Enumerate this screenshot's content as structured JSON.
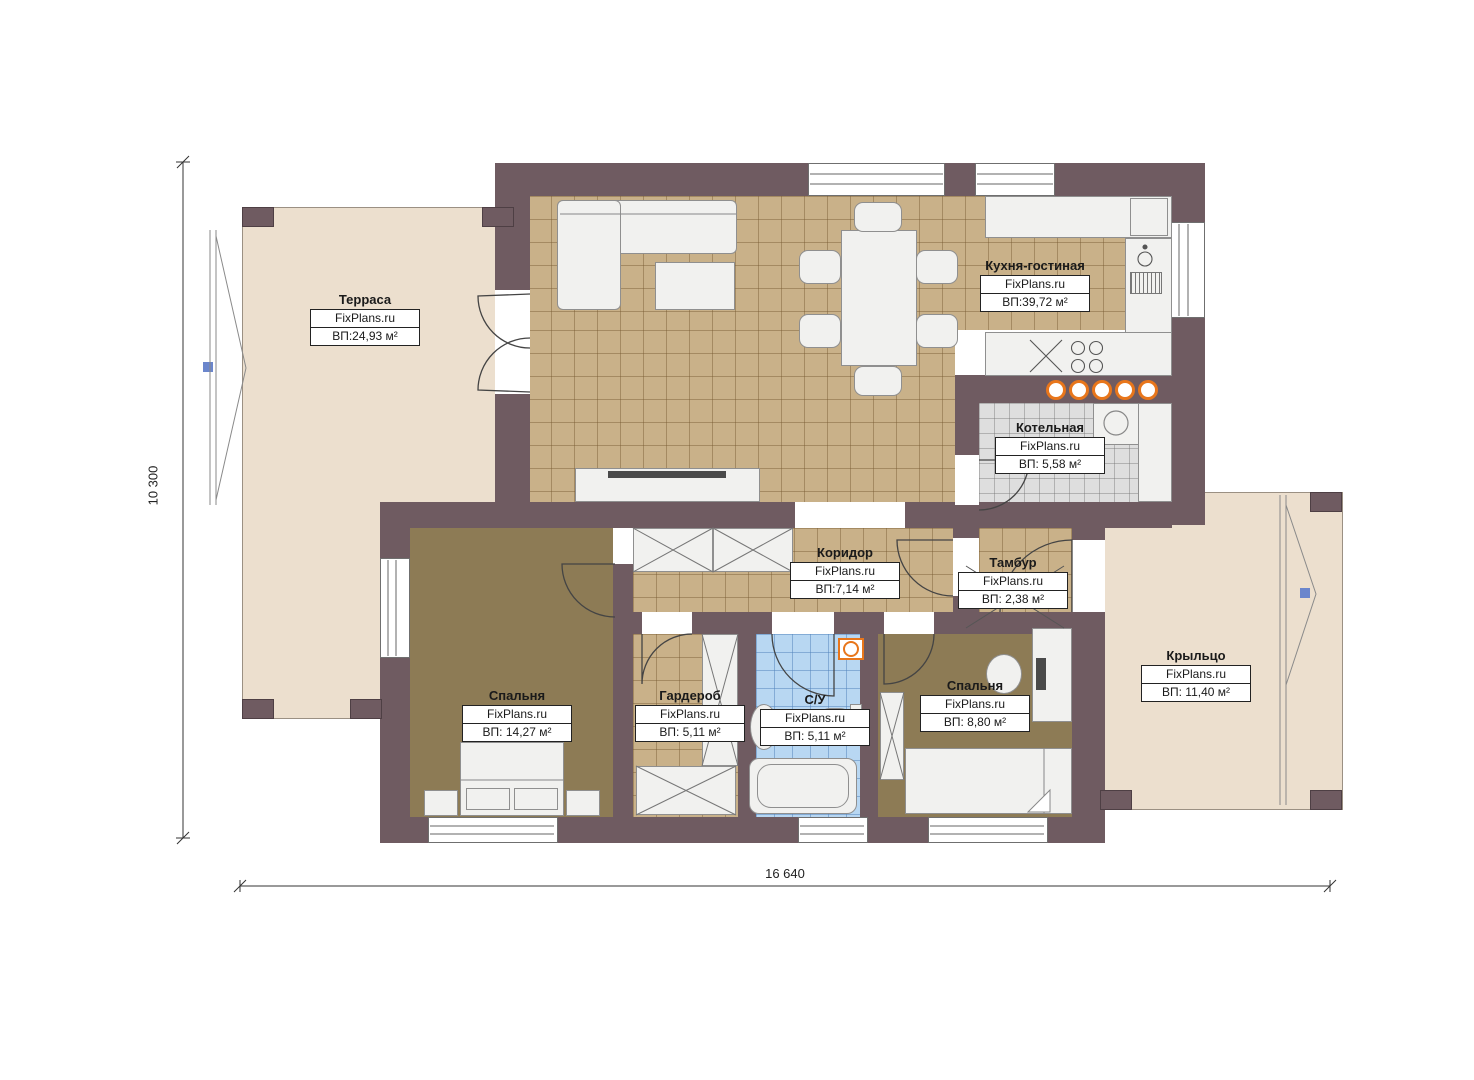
{
  "plan": {
    "type": "floor-plan",
    "brand_watermark": "FixPlans.ru",
    "dimensions": {
      "width_label": "16 640",
      "height_label": "10 300"
    },
    "colors": {
      "wall": "#6f5b61",
      "tile_floor": "#c9b189",
      "carpet": "#8d7b55",
      "bathroom_tile": "#b8d7f2",
      "boiler_tile": "#dedede",
      "terrace_deck": "#ecdfce",
      "accent_orange": "#e8761b",
      "marker_blue": "#6b86cc"
    }
  },
  "rooms": [
    {
      "name": "Терраса",
      "brand": "FixPlans.ru",
      "area": "ВП:24,93 м²"
    },
    {
      "name": "Кухня-гостиная",
      "brand": "FixPlans.ru",
      "area": "ВП:39,72 м²"
    },
    {
      "name": "Котельная",
      "brand": "FixPlans.ru",
      "area": "ВП: 5,58 м²"
    },
    {
      "name": "Коридор",
      "brand": "FixPlans.ru",
      "area": "ВП:7,14 м²"
    },
    {
      "name": "Тамбур",
      "brand": "FixPlans.ru",
      "area": "ВП: 2,38 м²"
    },
    {
      "name": "Спальня",
      "brand": "FixPlans.ru",
      "area": "ВП: 14,27 м²"
    },
    {
      "name": "Гардероб",
      "brand": "FixPlans.ru",
      "area": "ВП: 5,11 м²"
    },
    {
      "name": "С/У",
      "brand": "FixPlans.ru",
      "area": "ВП: 5,11 м²"
    },
    {
      "name": "Спальня",
      "brand": "FixPlans.ru",
      "area": "ВП: 8,80 м²"
    },
    {
      "name": "Крыльцо",
      "brand": "FixPlans.ru",
      "area": "ВП: 11,40 м²"
    }
  ]
}
